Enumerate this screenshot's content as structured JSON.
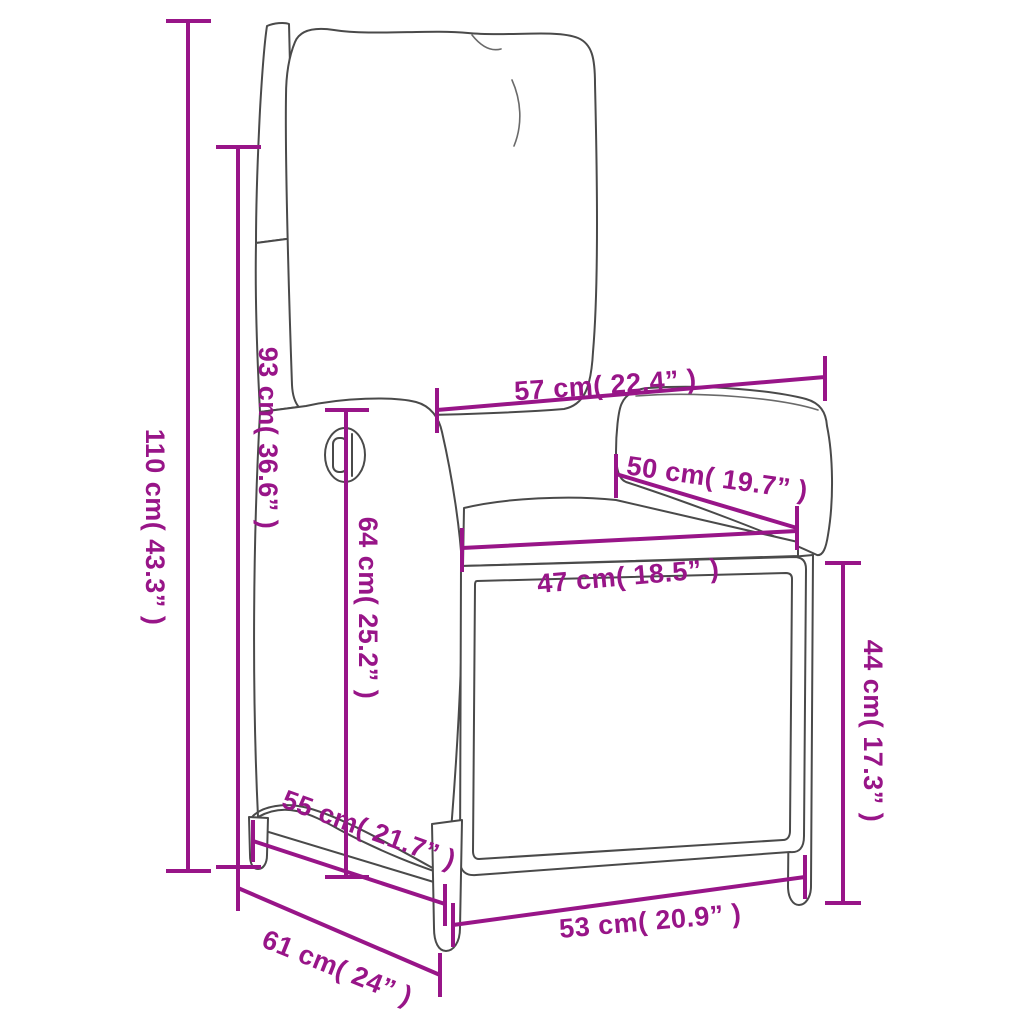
{
  "colors": {
    "dimension_magenta": "#981588",
    "drawing_outline": "#4A4A4A",
    "background": "#FFFFFF"
  },
  "figure": "line drawing of a reclining wicker garden chair with cushions, annotated with measurements",
  "dimensions": [
    {
      "id": "dim-110cm",
      "cm": 110,
      "inch": 43.3,
      "label": "110 cm( 43.3” )",
      "orientation": "vertical"
    },
    {
      "id": "dim-93cm",
      "cm": 93,
      "inch": 36.6,
      "label": "93 cm( 36.6” )",
      "orientation": "vertical"
    },
    {
      "id": "dim-57cm",
      "cm": 57,
      "inch": 22.4,
      "label": "57 cm( 22.4” )",
      "orientation": "horizontal"
    },
    {
      "id": "dim-50cm",
      "cm": 50,
      "inch": 19.7,
      "label": "50 cm( 19.7” )",
      "orientation": "diagonal"
    },
    {
      "id": "dim-47cm",
      "cm": 47,
      "inch": 18.5,
      "label": "47 cm( 18.5” )",
      "orientation": "horizontal"
    },
    {
      "id": "dim-64cm",
      "cm": 64,
      "inch": 25.2,
      "label": "64 cm( 25.2” )",
      "orientation": "vertical"
    },
    {
      "id": "dim-44cm",
      "cm": 44,
      "inch": 17.3,
      "label": "44 cm( 17.3” )",
      "orientation": "vertical"
    },
    {
      "id": "dim-55cm",
      "cm": 55,
      "inch": 21.7,
      "label": "55 cm( 21.7” )",
      "orientation": "diagonal"
    },
    {
      "id": "dim-53cm",
      "cm": 53,
      "inch": 20.9,
      "label": "53 cm( 20.9” )",
      "orientation": "horizontal"
    },
    {
      "id": "dim-61cm",
      "cm": 61,
      "inch": 24,
      "label": "61 cm( 24” )",
      "orientation": "diagonal"
    }
  ]
}
